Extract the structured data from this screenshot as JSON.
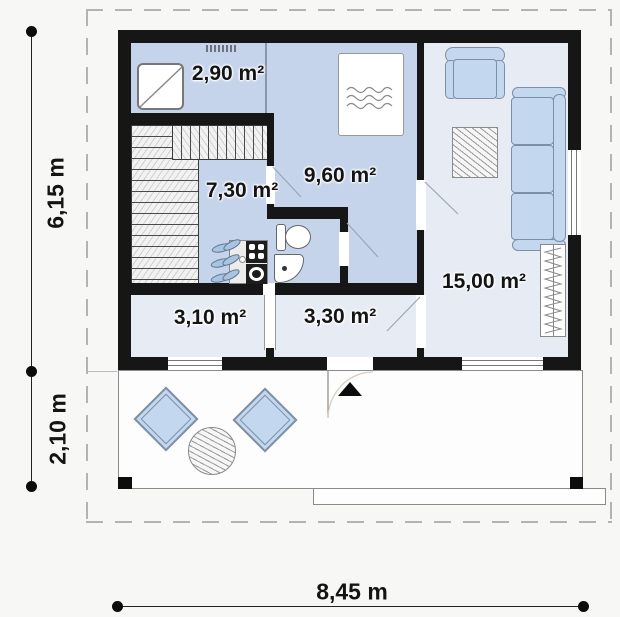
{
  "title": "single-storey house floor plan with terrace",
  "rooms": [
    {
      "name": "shower-room",
      "area_label": "2,90 m²"
    },
    {
      "name": "hall-kitchen",
      "area_label": "7,30 m²"
    },
    {
      "name": "bedroom",
      "area_label": "9,60 m²"
    },
    {
      "name": "living-room",
      "area_label": "15,00 m²"
    },
    {
      "name": "storage-room",
      "area_label": "3,10 m²"
    },
    {
      "name": "entry-hall",
      "area_label": "3,30 m²"
    }
  ],
  "dimensions": {
    "house_depth": "6,15 m",
    "terrace_depth": "2,10 m",
    "house_width": "8,45 m"
  },
  "furniture_icons": [
    "shower-icon",
    "bed-icon",
    "toilet-icon",
    "corner-sink-icon",
    "stove-icon",
    "washing-machine-icon",
    "plants-icon",
    "armchair-icon",
    "sofa-icon",
    "rug-icon",
    "radiator-icon",
    "staircase-hatch",
    "terrace-chair-icon",
    "terrace-table-icon",
    "entrance-arrow-icon",
    "vent-grille-icon"
  ],
  "colors": {
    "wall": "#161616",
    "room_fill_blue": "#c5d4ea",
    "room_fill_light": "#e7ecf4",
    "furniture_fill": "#c3d7ee",
    "furniture_border": "#7d8fa6",
    "background": "#f7f7f6",
    "dashed_border": "#b3b3b3"
  }
}
